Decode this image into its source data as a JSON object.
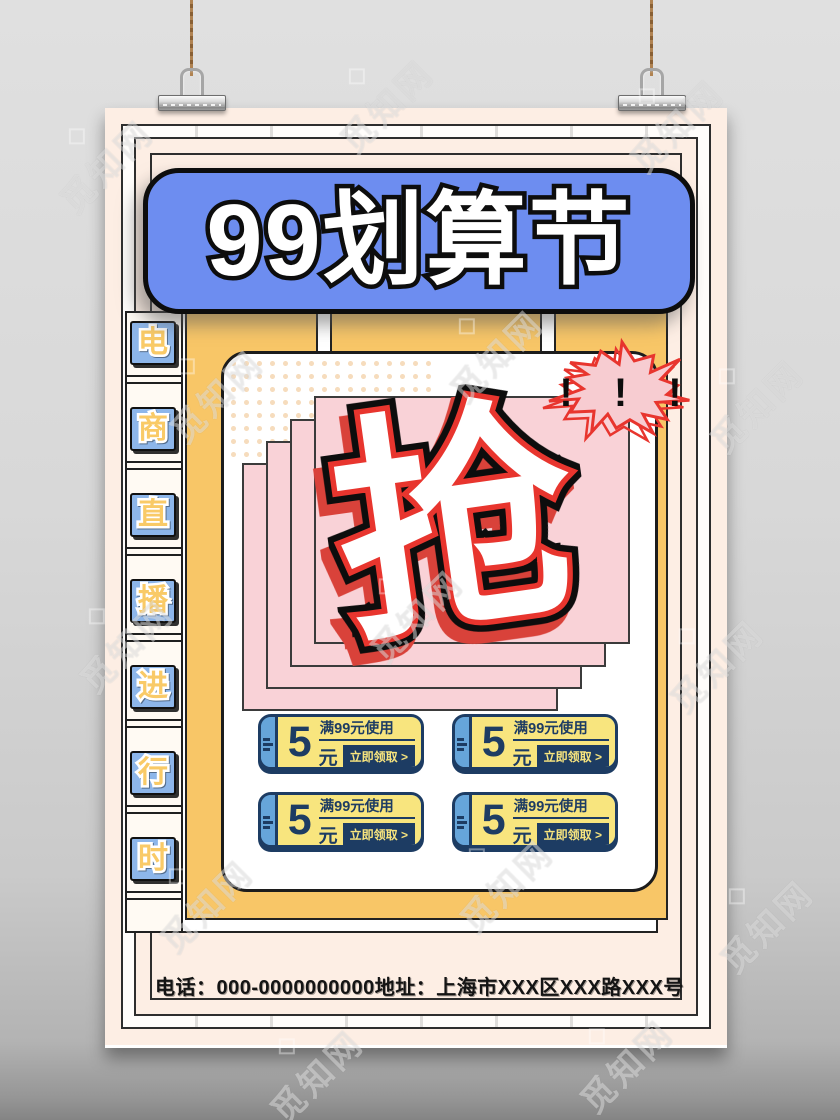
{
  "watermark": {
    "text": "觅知网"
  },
  "title": {
    "text": "99划算节"
  },
  "sidebar": {
    "label": "电商直播进行时",
    "chars": [
      "电",
      "商",
      "直",
      "播",
      "进",
      "行",
      "时"
    ]
  },
  "hero": {
    "grab_char": "抢",
    "burst_text": "! ! !"
  },
  "coupons": {
    "items": [
      {
        "amount": "5",
        "unit": "元",
        "condition": "满99元使用",
        "cta": "立即领取 >"
      },
      {
        "amount": "5",
        "unit": "元",
        "condition": "满99元使用",
        "cta": "立即领取 >"
      },
      {
        "amount": "5",
        "unit": "元",
        "condition": "满99元使用",
        "cta": "立即领取 >"
      },
      {
        "amount": "5",
        "unit": "元",
        "condition": "满99元使用",
        "cta": "立即领取 >"
      }
    ]
  },
  "footer": {
    "contact": "电话：000-0000000000地址：上海市XXX区XXX路XXX号"
  },
  "colors": {
    "poster_bg": "#fdeee4",
    "title_blue": "#6d8df0",
    "panel_yellow": "#f8c667",
    "card_pink": "#f9d2d7",
    "accent_red": "#e8352e",
    "burst_pink": "#f7ccd1",
    "coupon_yellow": "#f8e57e",
    "coupon_navy": "#1d3c63",
    "tab_blue": "#66a5da",
    "sidebar_blue": "#8db6ea",
    "char_yellow": "#f9ca67"
  }
}
